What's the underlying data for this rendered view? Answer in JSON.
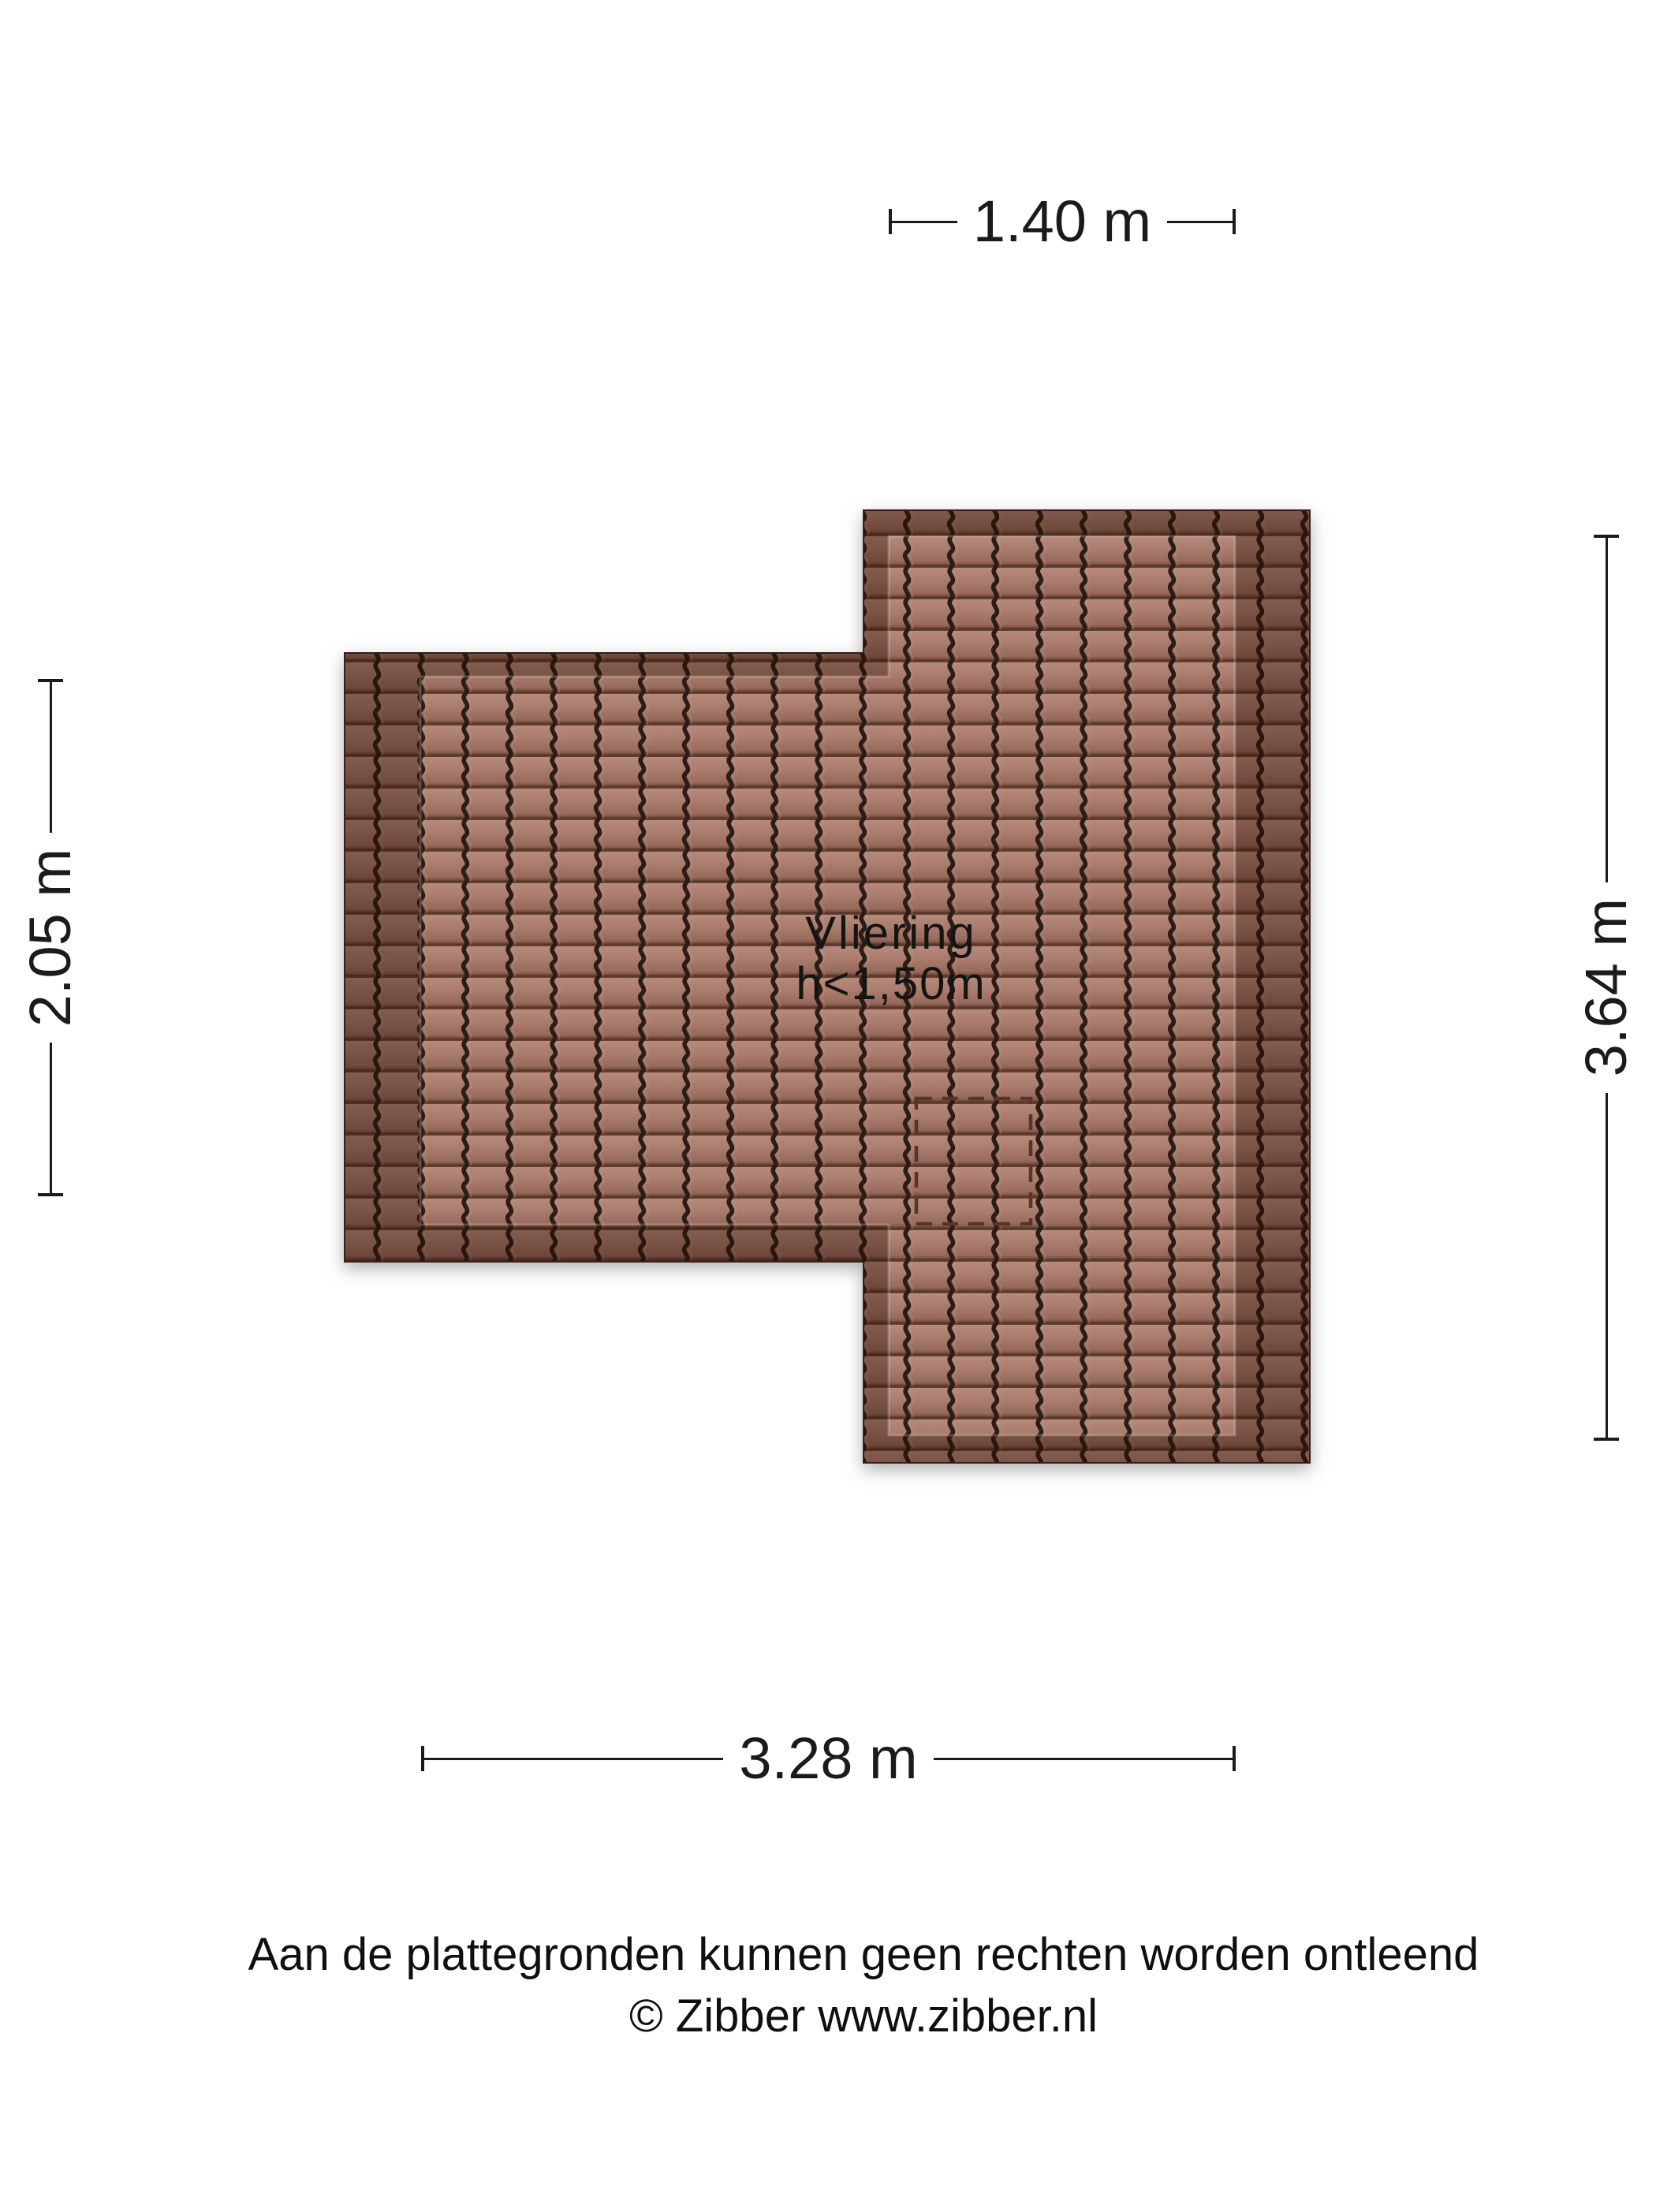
{
  "plan": {
    "room": {
      "name": "Vliering",
      "height_note": "h<1,50m"
    },
    "dimensions": {
      "top": "1.40 m",
      "left": "2.05 m",
      "right": "3.64 m",
      "bottom": "3.28 m"
    },
    "colors": {
      "tile_base": "#a87a6c",
      "tile_border_overlay": "#795346",
      "tile_groove": "#2a1a14",
      "hatch_dash": "#5a332a",
      "dimension_line": "#1b1b1b",
      "text": "#141414"
    }
  },
  "footer": {
    "disclaimer": "Aan de plattegronden kunnen geen rechten worden ontleend",
    "copyright": "© Zibber www.zibber.nl"
  }
}
